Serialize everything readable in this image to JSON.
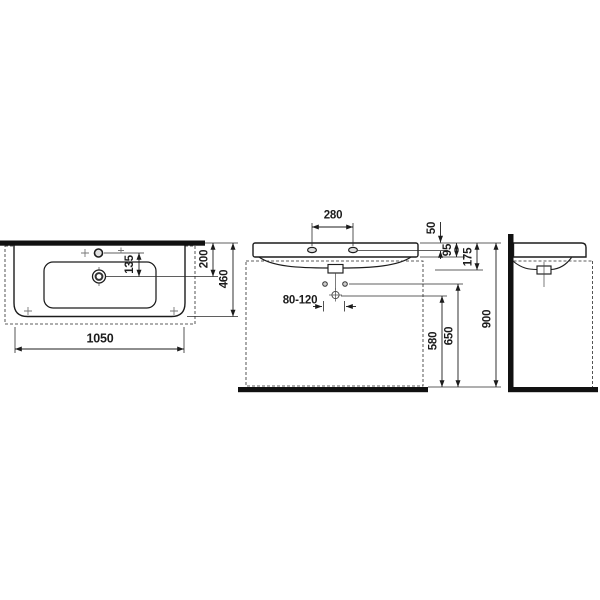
{
  "colors": {
    "background": "#ffffff",
    "line": "#1c1c1c",
    "hole_fill": "#dddddd"
  },
  "top_view": {
    "labels": {
      "overall_width": "1050",
      "overall_depth": "460",
      "rear_to_drain": "200",
      "tap_to_drain": "135"
    }
  },
  "front_view": {
    "labels": {
      "tap_hole_spacing": "280",
      "rim_to_tap_hole": "50",
      "apron_height": "95",
      "basin_body_height": "175",
      "trap_offset_range": "80-120",
      "trap_height": "580",
      "fixing_bolt_height": "650",
      "rim_height": "900"
    }
  }
}
